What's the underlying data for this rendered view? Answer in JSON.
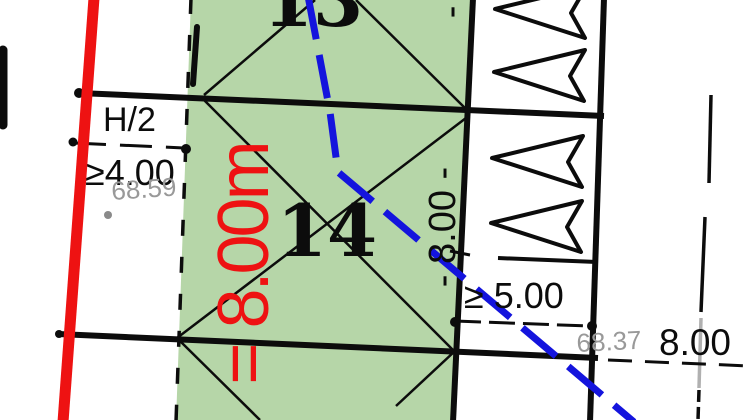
{
  "plan": {
    "type": "cadastral-site-plan",
    "colors": {
      "parcel_green": "#b6d6a8",
      "line_black": "#0c0c0c",
      "red_line": "#ee1212",
      "blue_line": "#1414dd",
      "gray_label": "#999999",
      "background": "#ffffff"
    },
    "parcels": {
      "top_number": "13",
      "main_number": "14"
    },
    "dimensions": {
      "red_depth": "= 8.00m",
      "depth_top_parcel": "- 8.00 -",
      "depth_main_parcel": "- 8.00 -",
      "height_ratio": "H/2",
      "min_front_setback": "≥4.00",
      "min_side_setback": "≥ 5.00",
      "right_width": "8.00"
    },
    "elevations": {
      "left_spot": "68.59",
      "right_spot": "68.37"
    },
    "symbols": {
      "arrow_direction": "left",
      "arrow_count": 4
    }
  }
}
